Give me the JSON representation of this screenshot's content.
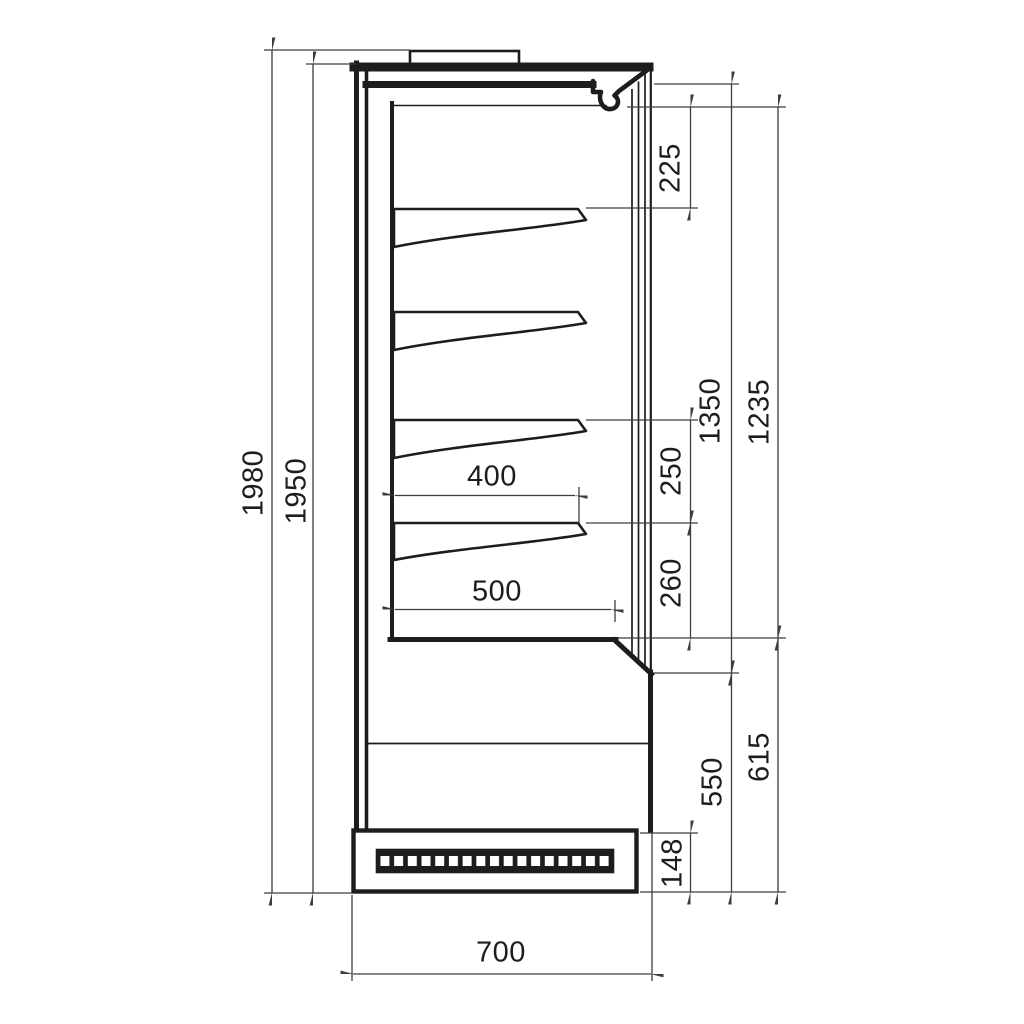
{
  "diagram": {
    "type": "technical-dimension-drawing",
    "subject": "refrigerated-display-cabinet-side-section",
    "shelf_count": 4,
    "line_color": "#1d1d1b",
    "thin_line_color": "#3d3d3d",
    "background_color": "#ffffff"
  },
  "dims": {
    "d1980": "1980",
    "d1950": "1950",
    "d225": "225",
    "d1350": "1350",
    "d1235": "1235",
    "d250": "250",
    "d260": "260",
    "d400": "400",
    "d500": "500",
    "d550": "550",
    "d615": "615",
    "d148": "148",
    "d700": "700"
  }
}
